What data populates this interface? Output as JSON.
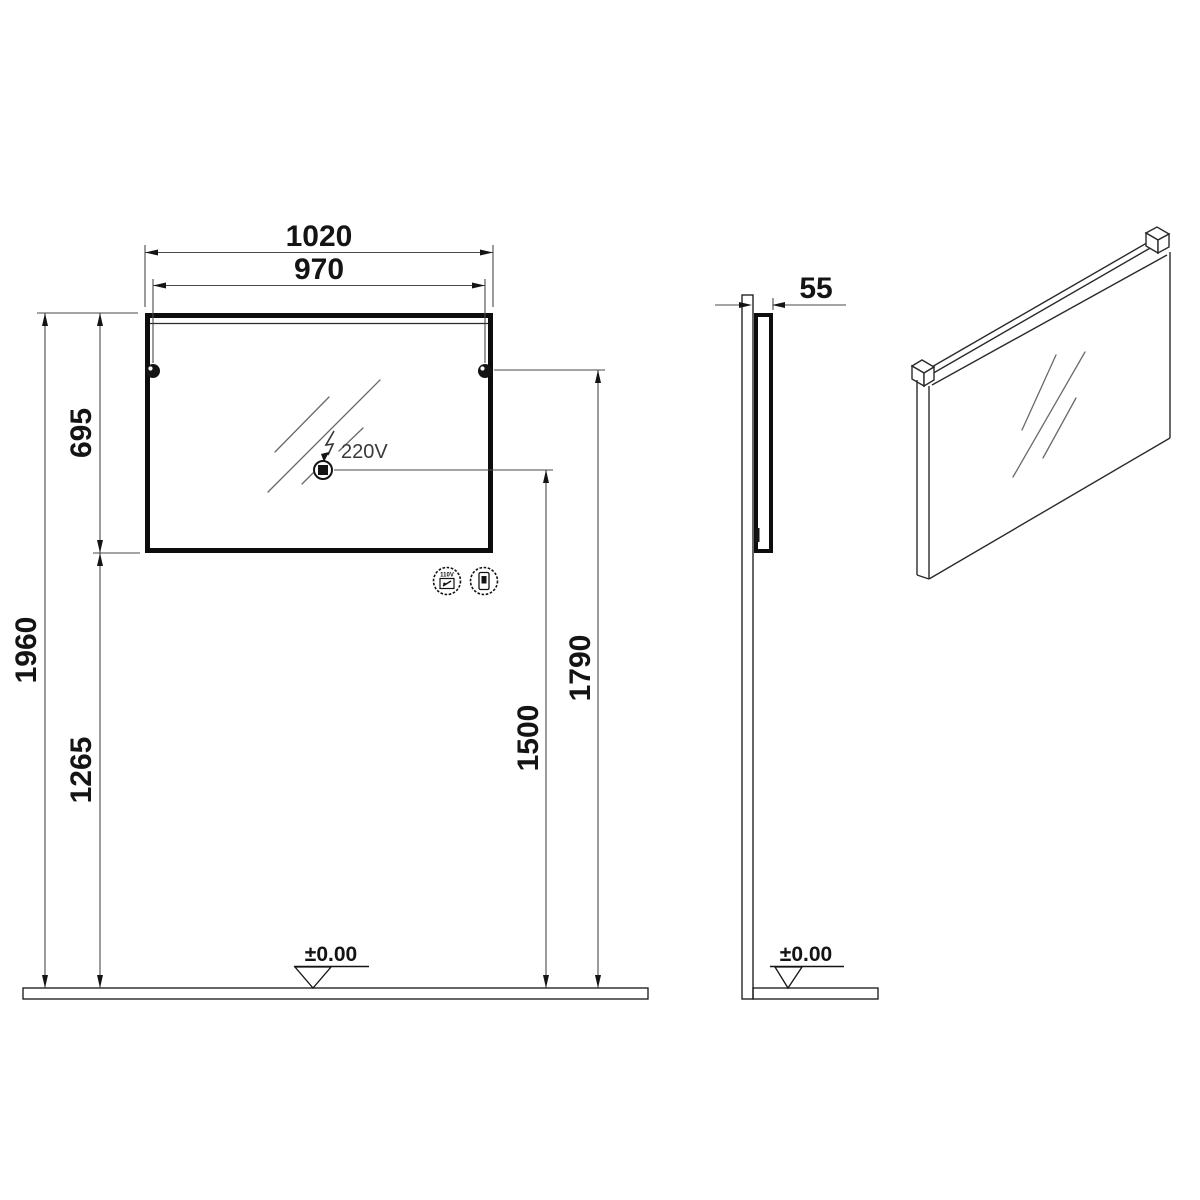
{
  "drawing": {
    "front": {
      "dim_overall_width": "1020",
      "dim_fixing_centers": "970",
      "dim_mirror_height": "695",
      "dim_overall_height": "1960",
      "dim_floor_to_bottom": "1265",
      "dim_floor_to_fixings": "1790",
      "dim_floor_to_socket": "1500",
      "socket_voltage": "220V",
      "floor_level": "±0.00",
      "shaver_socket_icon_label": "110V"
    },
    "side": {
      "dim_depth": "55",
      "floor_level": "±0.00"
    },
    "colors": {
      "line": "#141414",
      "dim_line": "#4a4a4a",
      "background": "#ffffff"
    }
  }
}
